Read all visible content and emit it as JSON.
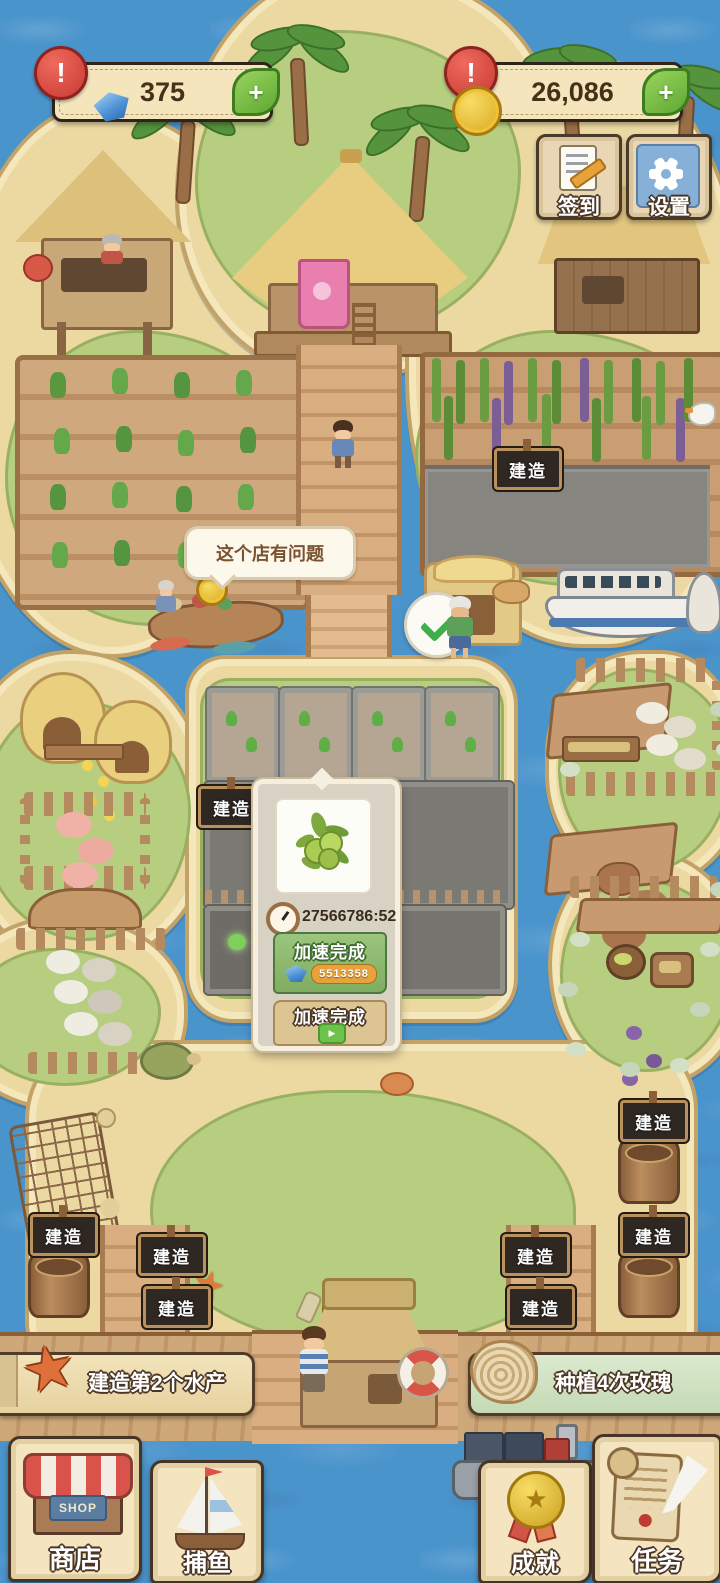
{
  "hud": {
    "gems": {
      "value": "375",
      "alert": "!",
      "add": "+"
    },
    "coins": {
      "value": "26,086",
      "alert": "!",
      "add": "+"
    },
    "signin": "签到",
    "settings": "设置"
  },
  "labels": {
    "build": "建造"
  },
  "speech_bubble": "这个店有问题",
  "popup": {
    "timer": "27566786:52",
    "item": "olive",
    "accelerate_gem": "加速完成",
    "gem_cost": "5513358",
    "accelerate_ad": "加速完成"
  },
  "quests": {
    "left": "建造第2个水产",
    "right": "种植4次玫瑰"
  },
  "nav": {
    "shop": "商店",
    "fishing": "捕鱼",
    "achievements": "成就",
    "tasks": "任务"
  },
  "icons": {
    "star": "★",
    "play": "▶",
    "shop_sign": "SHOP"
  },
  "colors": {
    "water": "#4a94cc",
    "sand": "#ecd9a2",
    "parchment": "#f2e4c0",
    "button_green": "#8fbe75",
    "alert_red": "#d6453e",
    "coin_gold": "#f0c235",
    "gem_blue": "#5aa0e0"
  }
}
